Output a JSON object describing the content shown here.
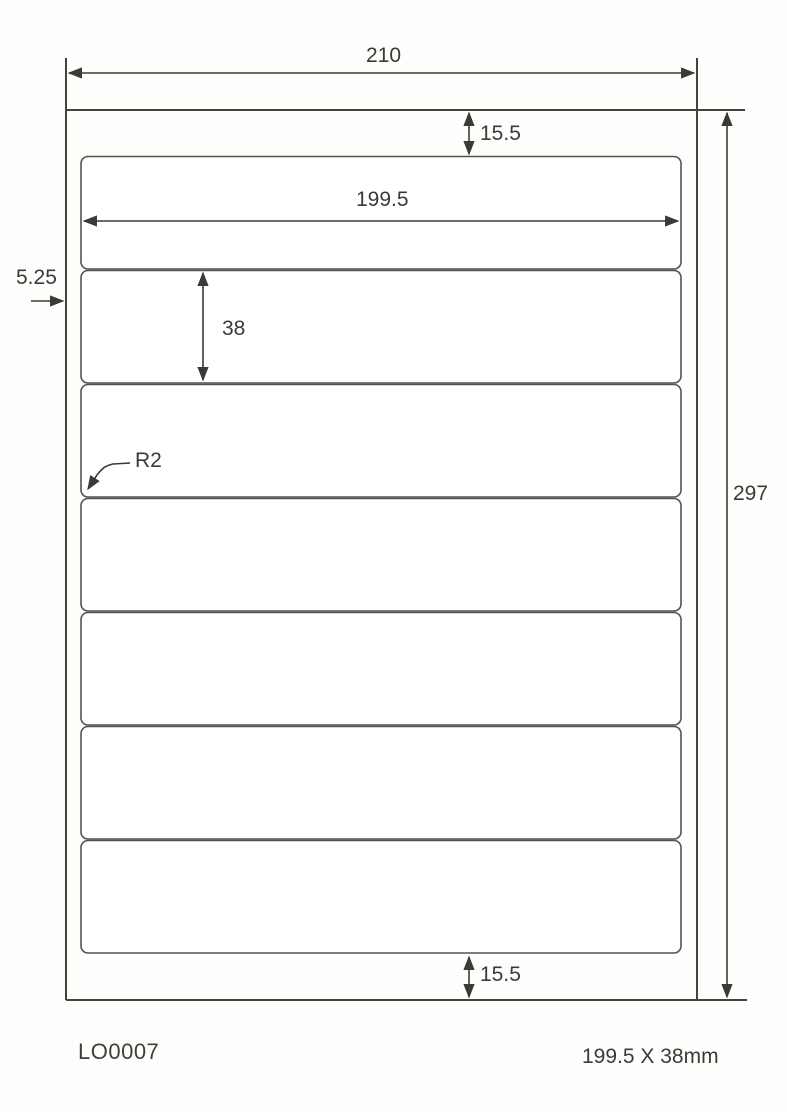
{
  "diagram": {
    "title": "label-sheet-dimension-drawing",
    "sheet": {
      "width_mm": "210",
      "height_mm": "297"
    },
    "label": {
      "width_mm": "199.5",
      "height_mm": "38",
      "corner_radius": "R2",
      "rows": 7,
      "columns": 1
    },
    "margins": {
      "top_mm": "15.5",
      "bottom_mm": "15.5",
      "left_mm": "5.25"
    },
    "footer": {
      "product_code": "LO0007",
      "label_size_note": "199.5 X 38mm"
    },
    "colors": {
      "background": "#fefefd",
      "sheet_line": "#45433f",
      "dimension_line": "#3c3a36",
      "label_border": "#56534e",
      "text": "#3b3a37"
    }
  }
}
